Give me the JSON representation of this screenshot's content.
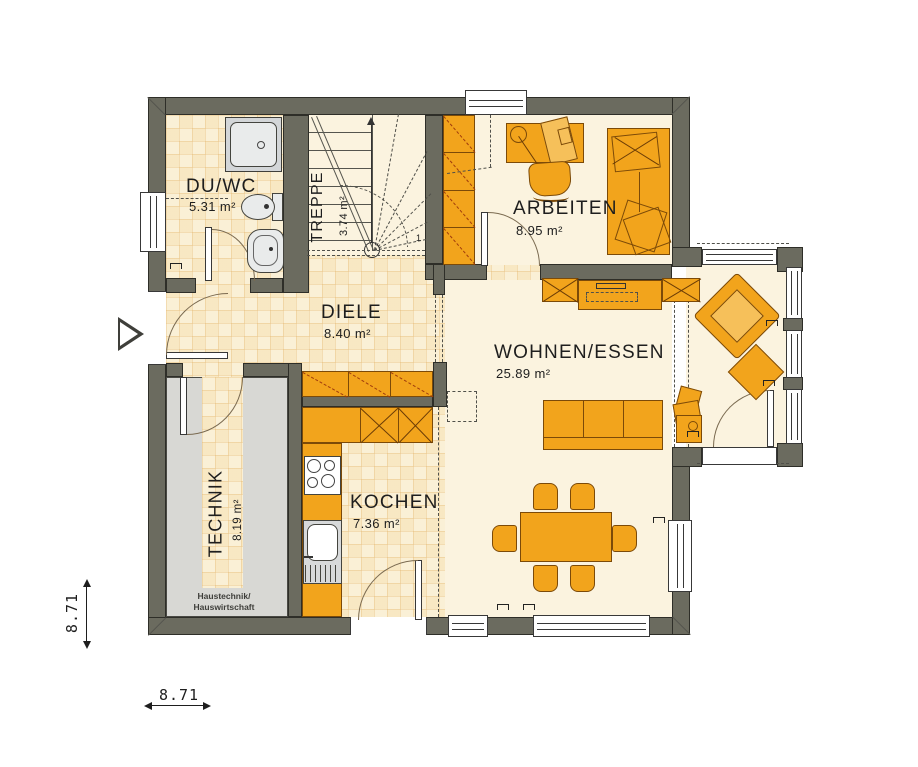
{
  "rooms": {
    "duwc": {
      "name": "DU/WC",
      "area": "5.31 m²"
    },
    "treppe": {
      "name": "TREPPE",
      "area": "3.74 m²",
      "start_label": "1"
    },
    "arbeiten": {
      "name": "ARBEITEN",
      "area": "8.95 m²"
    },
    "diele": {
      "name": "DIELE",
      "area": "8.40 m²"
    },
    "wohnen": {
      "name": "WOHNEN/ESSEN",
      "area": "25.89 m²"
    },
    "technik": {
      "name": "TECHNIK",
      "area": "8.19 m²",
      "note1": "Haustechnik/",
      "note2": "Hauswirtschaft"
    },
    "kochen": {
      "name": "KOCHEN",
      "area": "7.36 m²"
    }
  },
  "dimensions": {
    "vertical": "8.71",
    "horizontal": "8.71"
  },
  "colors": {
    "wall": "#6b6b5f",
    "furniture": "#f2a41c",
    "furniture_light": "#f6c05a",
    "floor_plain": "#fbf3df",
    "floor_tile": "#faf0d6",
    "technik_floor": "#d8d8d4",
    "fixture_gray": "#e9ebeb"
  }
}
